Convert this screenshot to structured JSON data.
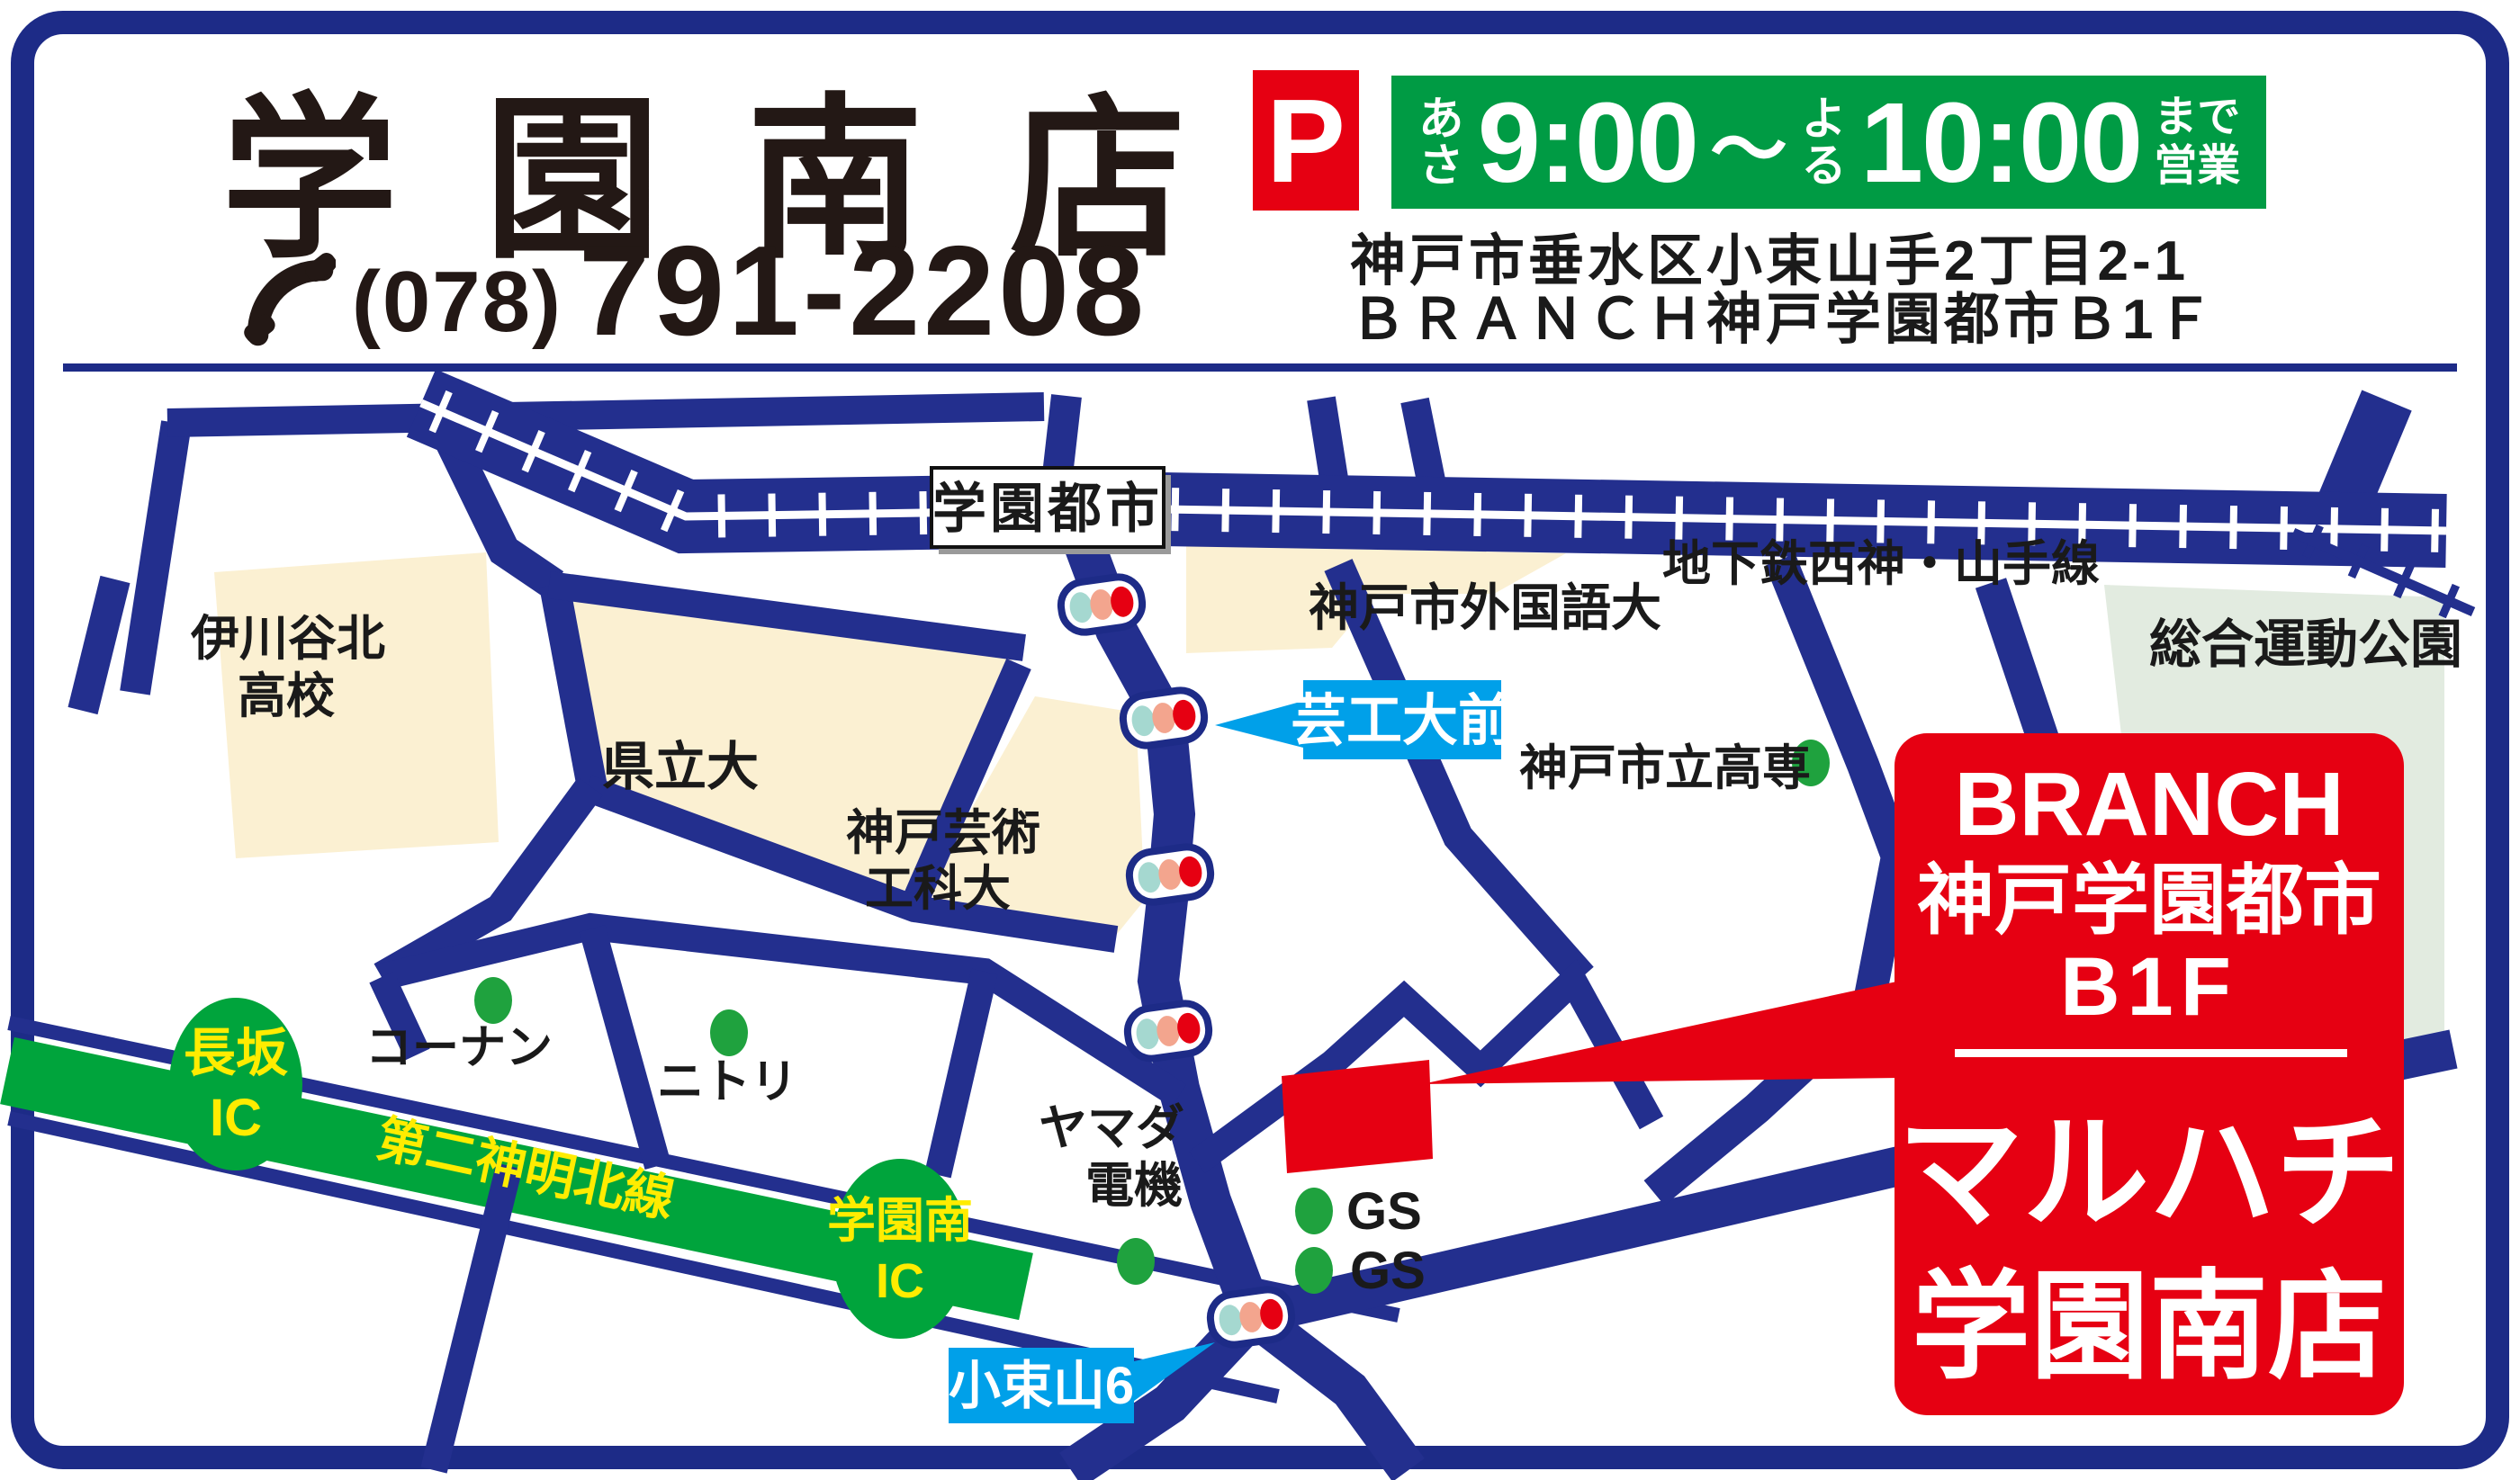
{
  "header": {
    "store_name": "学園南店",
    "phone": {
      "area": "(078)",
      "number": "791-2208"
    },
    "parking": "P",
    "hours": {
      "morning": "あさ",
      "open": "9:00",
      "tilde": "〜",
      "evening": "よる",
      "close": "10:00",
      "until1": "まで",
      "until2": "営業"
    },
    "address1": "神戸市垂水区小束山手2丁目2-1",
    "address2": "ＢＲＡＮＣＨ神戸学園都市Ｂ1Ｆ"
  },
  "map": {
    "station": "学園都市",
    "rail_line": "地下鉄西神・山手線",
    "areas": {
      "ikawadani1": "伊川谷北",
      "ikawadani2": "高校",
      "kenritsudai": "県立大",
      "geiko1": "神戸芸術",
      "geiko2": "工科大",
      "gaikokugo": "神戸市外国語大",
      "park": "総合運動公園"
    },
    "pois": {
      "kosen": "神戸市立高専",
      "konan": "コーナン",
      "nitori": "ニトリ",
      "yamada1": "ヤマダ",
      "yamada2": "電機",
      "gs1": "GS",
      "gs2": "GS"
    },
    "signs": {
      "geikodai": "芸工大前",
      "kozukayama": "小束山6"
    },
    "highway": {
      "name": "第二神明北線",
      "ic_west1": "長坂",
      "ic_west2": "IC",
      "ic_east1": "学園南",
      "ic_east2": "IC"
    },
    "store_box": {
      "line1": "BRANCH",
      "line2": "神戸学園都市",
      "line3": "B1F",
      "brand": "マルハチ",
      "branch": "学園南店"
    }
  },
  "theme": {
    "navy": "#1d2b87",
    "road": "#232f8e",
    "red": "#e60012",
    "banner": "#009b44",
    "hwy": "#00a43c",
    "dot": "#1fa23e",
    "sign": "#00a0e9",
    "cream": "#fbf0d2",
    "park": "#e2ebe0",
    "tlteal": "#a5d8d0",
    "tlsalmon": "#f3a58e",
    "yellow": "#ffec00",
    "ink": "#231815"
  }
}
